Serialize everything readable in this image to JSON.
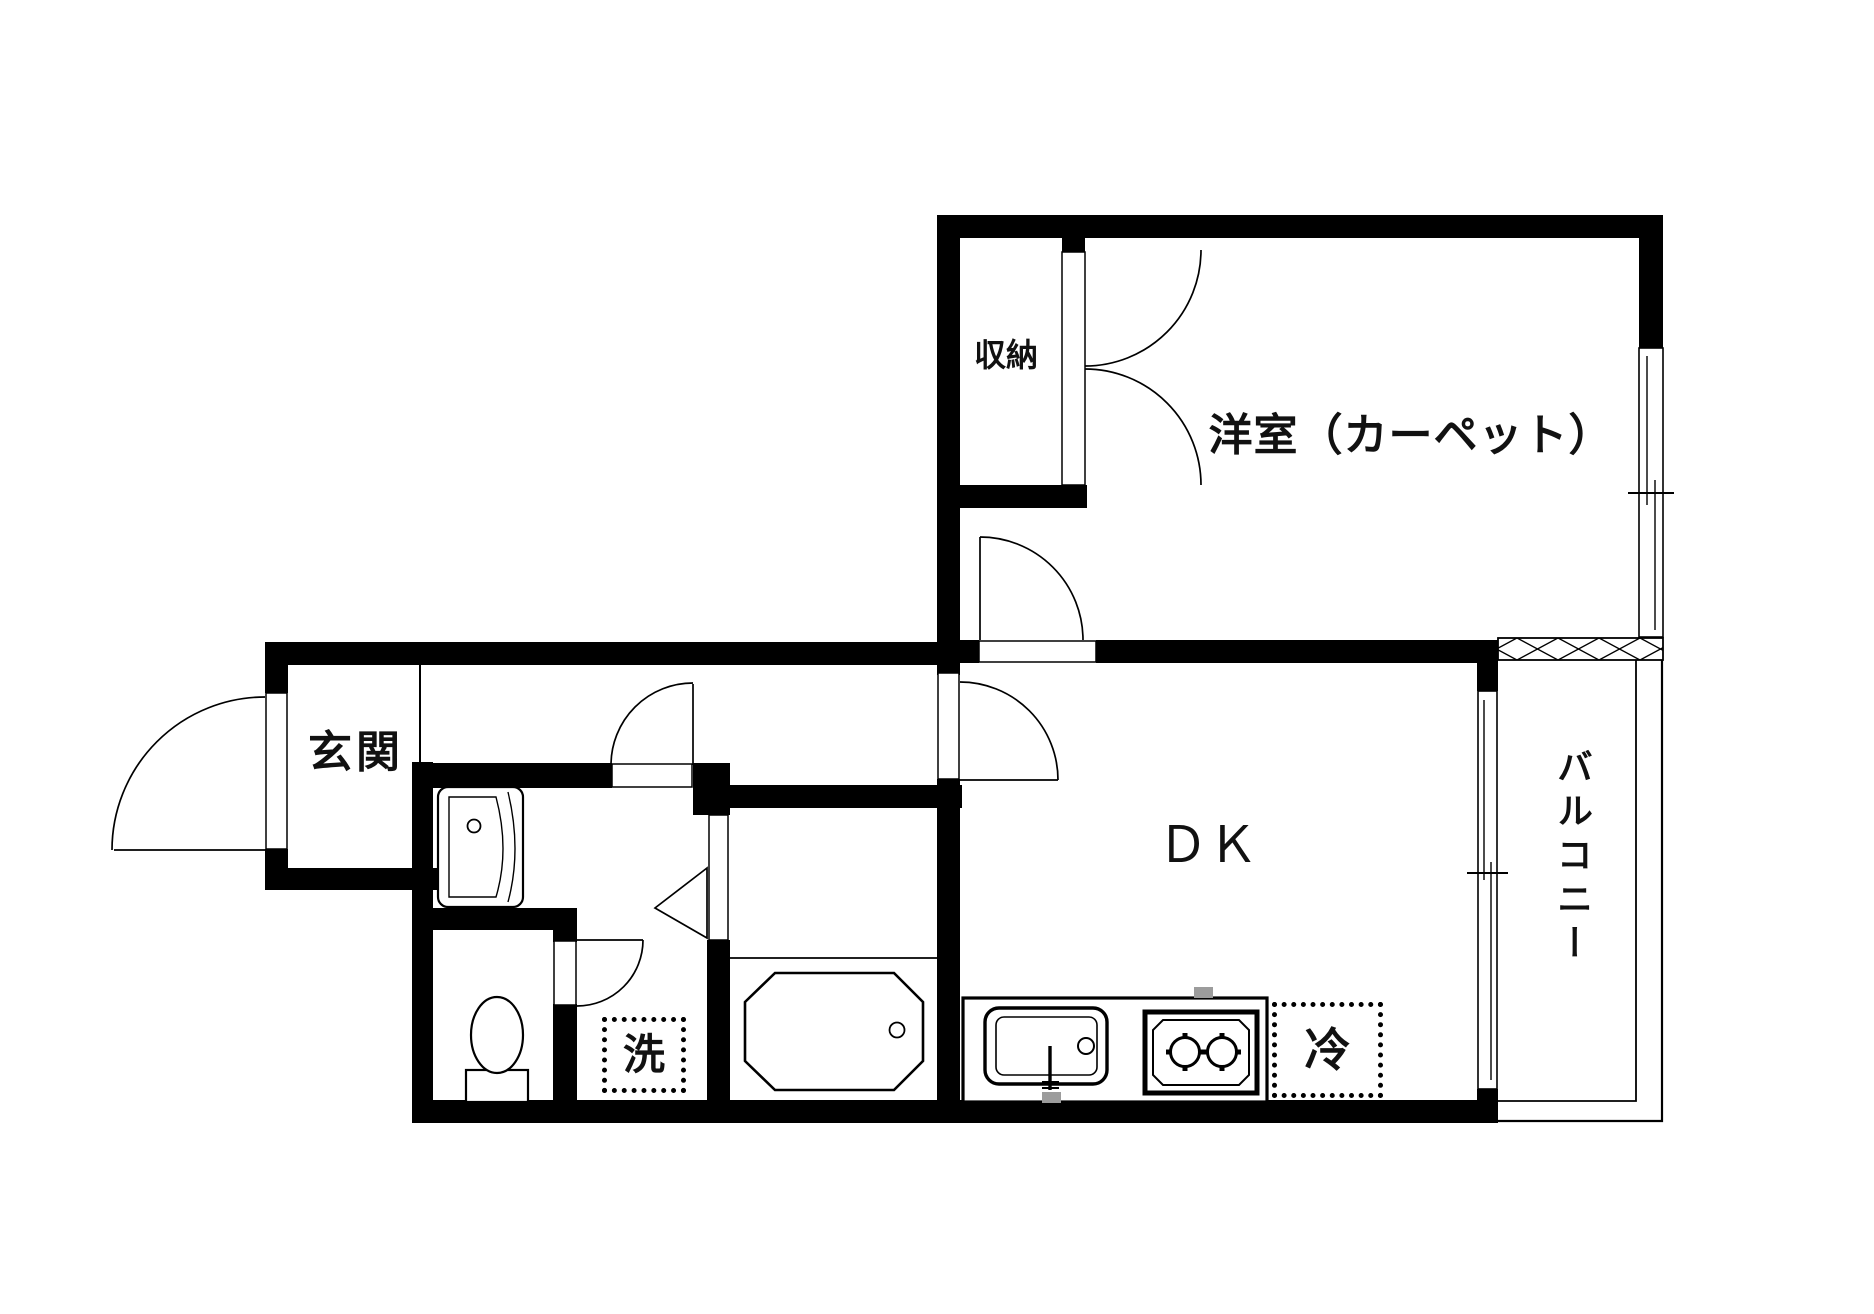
{
  "floorplan": {
    "title": "apartment-floor-plan",
    "colors": {
      "background": "#ffffff",
      "walls": "#000000",
      "lines": "#000000",
      "utility_gray": "#9c9c9c"
    },
    "rooms": {
      "storage": {
        "label": "収納"
      },
      "western_room": {
        "label": "洋室（カーペット）"
      },
      "entrance": {
        "label": "玄関"
      },
      "dining_kitchen": {
        "label": "ＤＫ"
      },
      "balcony": {
        "label": "バルコニー"
      },
      "washer_space": {
        "label": "洗"
      },
      "refrigerator_space": {
        "label": "冷"
      }
    },
    "icons": [
      "hinged-door-arc",
      "double-closet-door",
      "folding-bath-door",
      "sliding-window",
      "balcony-railing",
      "partition-hatch",
      "toilet",
      "vanity-sink",
      "bathtub",
      "kitchen-sink",
      "two-burner-stove"
    ]
  }
}
